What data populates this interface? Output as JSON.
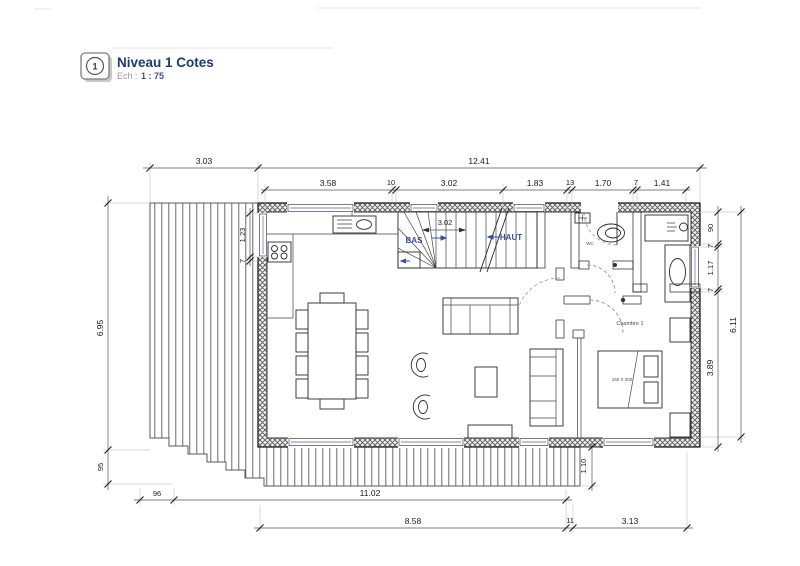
{
  "title_block": {
    "number": "1",
    "title": "Niveau 1 Cotes",
    "scale_label": "Ech :",
    "scale_value": "1 : 75"
  },
  "plan_labels": {
    "stairs_down": "BAS",
    "stairs_up": "HAUT",
    "stairs_width": "3.02",
    "wc": "WC",
    "bedroom": "Chambre 1",
    "bed_size": "160 X 200"
  },
  "dimensions": {
    "top_outer": [
      "3.03",
      "12.41"
    ],
    "top_inner": [
      "3.58",
      "10",
      "3.02",
      "1.83",
      "13",
      "1.70",
      "7",
      "1.41"
    ],
    "left_outer": [
      "6.95",
      "95"
    ],
    "left_inner": [
      "1.23",
      "7"
    ],
    "right_inner": [
      "90",
      "7",
      "1.17",
      "7",
      "3.89"
    ],
    "right_outer": "6.11",
    "bottom_inner": [
      "96",
      "11.02"
    ],
    "bottom_outer": [
      "8.58",
      "11",
      "3.13"
    ],
    "deck_depth": "1.10"
  },
  "colors": {
    "line": "#2b2b2b",
    "label_blue": "#3b4fa2",
    "title_navy": "#1d3a6e",
    "scale_gray": "#9a9a9a",
    "scale_value_blue": "#3d5588",
    "glazing_blue": "#7b85c4"
  }
}
